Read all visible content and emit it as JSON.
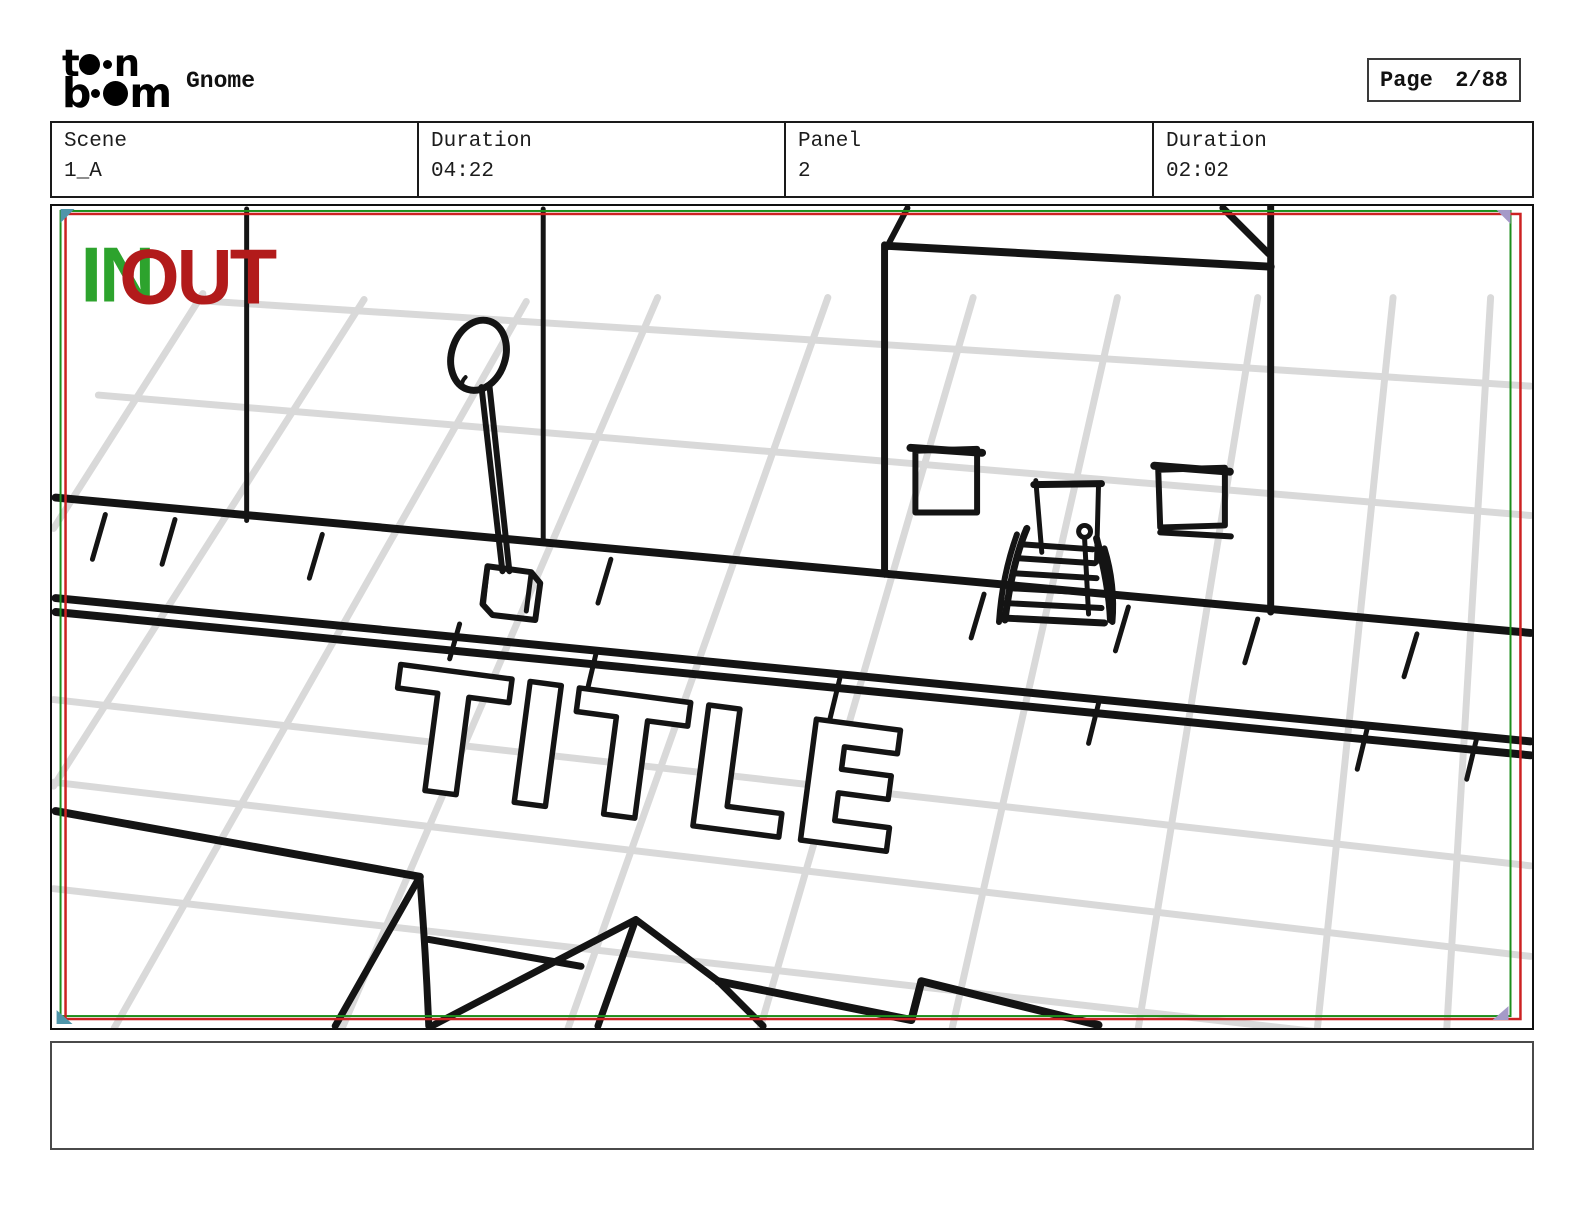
{
  "header": {
    "logo": {
      "line1_start": "t",
      "line1_end": "n",
      "line2_start": "b",
      "line2_end": "m"
    },
    "project_title": "Gnome",
    "page_label": "Page",
    "page_number": "2/88"
  },
  "info_bar": {
    "cells": [
      {
        "label": "Scene",
        "value": "1_A"
      },
      {
        "label": "Duration",
        "value": "04:22"
      },
      {
        "label": "Panel",
        "value": "2"
      },
      {
        "label": "Duration",
        "value": "02:02"
      }
    ]
  },
  "panel": {
    "in_label": "IN",
    "out_label": "OUT",
    "colors": {
      "in_green": "#2da32d",
      "out_red": "#b21b1b",
      "camera_frame_red": "#cc2222",
      "camera_frame_green": "#1d8f1d",
      "grid_gray": "#d9d9d9",
      "sketch_black": "#141414",
      "marker_teal": "#4e95aa",
      "marker_purple": "#a59ac8"
    },
    "drawing": {
      "title_text": "TITLE"
    }
  },
  "caption": {
    "text": ""
  }
}
